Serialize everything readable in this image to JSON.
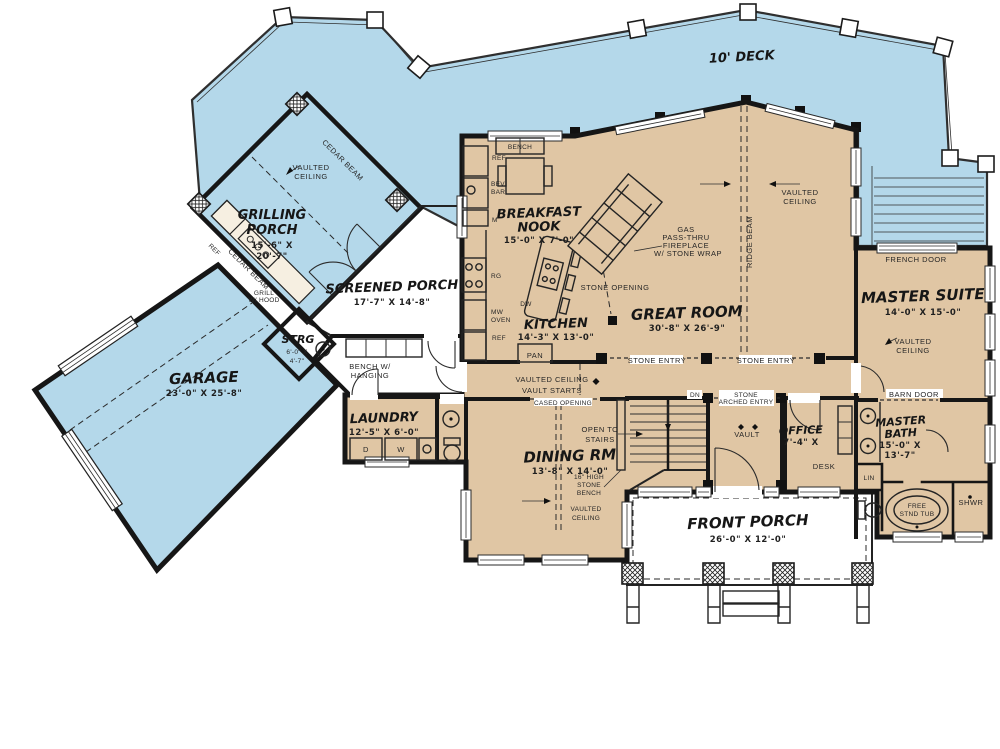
{
  "colors": {
    "outdoor": "#b4d8ea",
    "indoor": "#e0c6a4",
    "wall": "#161616",
    "line": "#2e2e2e",
    "background": "#ffffff"
  },
  "rooms": {
    "deck": {
      "name": "10' DECK"
    },
    "grilling_porch": {
      "name1": "GRILLING",
      "name2": "PORCH",
      "dim1": "15'-6\" X",
      "dim2": "20'-7\""
    },
    "screened_porch": {
      "name": "SCREENED PORCH",
      "dims": "17'-7\" X 14'-8\""
    },
    "garage": {
      "name": "GARAGE",
      "dims": "23'-0\" X 25'-8\""
    },
    "strg": {
      "name": "STRG",
      "dim1": "6'-0\" X",
      "dim2": "4'-7\""
    },
    "breakfast_nook": {
      "name1": "BREAKFAST",
      "name2": "NOOK",
      "dims": "15'-0\" X 7'-0\""
    },
    "kitchen": {
      "name": "KITCHEN",
      "dims": "14'-3\" X 13'-0\""
    },
    "great_room": {
      "name": "GREAT ROOM",
      "dims": "30'-8\" X 26'-9\""
    },
    "master_suite": {
      "name": "MASTER SUITE",
      "dims": "14'-0\" X 15'-0\""
    },
    "master_bath": {
      "name1": "MASTER",
      "name2": "BATH",
      "dim1": "15'-0\" X",
      "dim2": "13'-7\""
    },
    "office": {
      "name": "OFFICE",
      "dims": "7'-4\" X"
    },
    "dining": {
      "name": "DINING RM",
      "dims": "13'-8\" X 14'-0\""
    },
    "laundry": {
      "name": "LAUNDRY",
      "dims": "12'-5\" X 6'-0\""
    },
    "front_porch": {
      "name": "FRONT PORCH",
      "dims": "26'-0\" X 12'-0\""
    }
  },
  "ann": {
    "vaulted": "VAULTED",
    "ceiling": "CEILING",
    "vaulted_ceiling": "VAULTED CEILING",
    "vault_starts": "VAULT STARTS",
    "cedar_beam": "CEDAR BEAM",
    "ridge_beam": "RIDGE BEAM",
    "ref": "REF",
    "bev": "BEV",
    "bar": "BAR",
    "m": "M",
    "rg": "RG",
    "dw": "DW",
    "mw": "MW",
    "oven": "OVEN",
    "pan": "PAN",
    "bench": "BENCH",
    "grill": "GRILL",
    "w_hood": "W/ HOOD",
    "bench_w": "BENCH W/",
    "hanging": "HANGING",
    "d": "D",
    "w": "W",
    "stone_opening": "STONE OPENING",
    "gas": "GAS",
    "pass_thru": "PASS-THRU",
    "fireplace": "FIREPLACE",
    "stone_wrap": "W/ STONE WRAP",
    "stone_entry": "STONE ENTRY",
    "french_door": "FRENCH DOOR",
    "barn_door": "BARN DOOR",
    "lin": "LIN",
    "shwr": "SHWR",
    "free": "FREE",
    "stnd_tub": "STND TUB",
    "cased_opening": "CASED OPENING",
    "dn": "DN",
    "stone": "STONE",
    "arched_entry": "ARCHED ENTRY",
    "vault": "VAULT",
    "desk": "DESK",
    "open_to": "OPEN TO",
    "stairs": "STAIRS",
    "bench_16": "16\" HIGH",
    "bench_stone": "STONE",
    "bench_bench": "BENCH"
  }
}
